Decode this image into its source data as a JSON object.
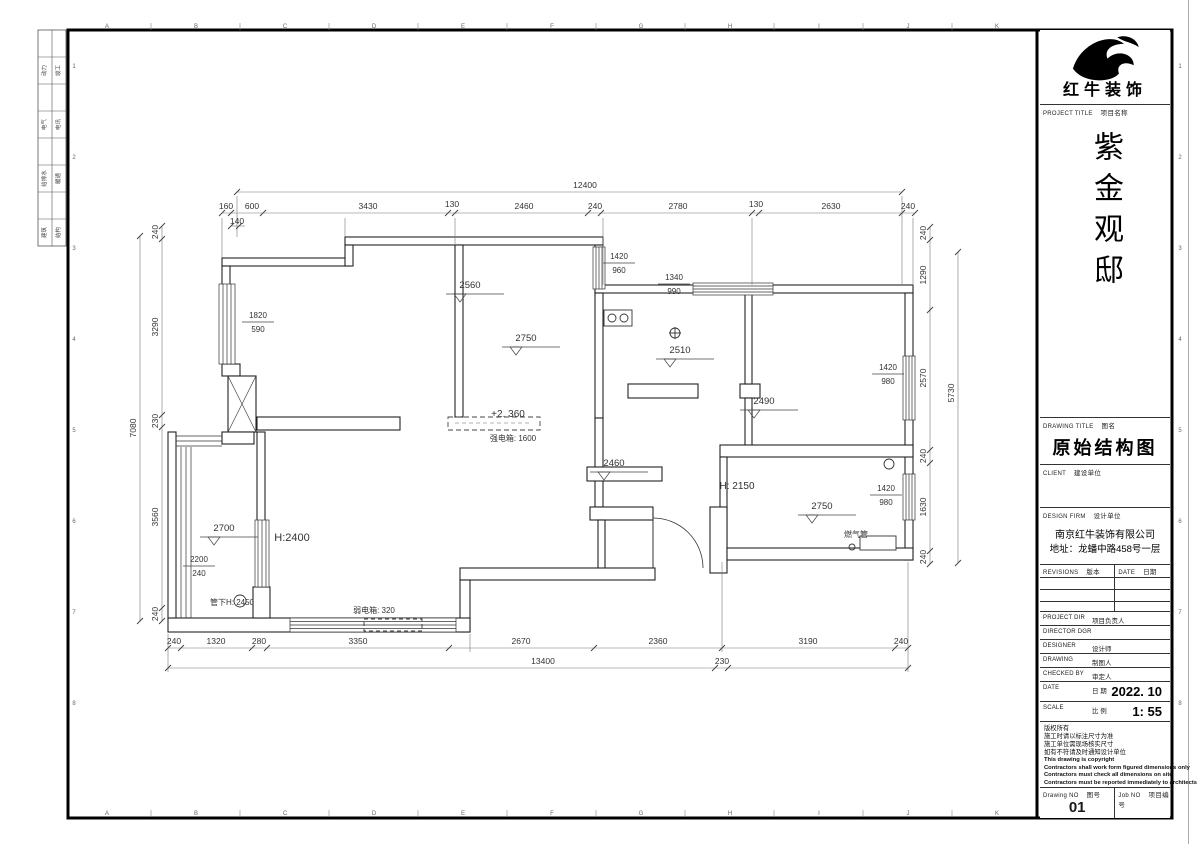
{
  "sheet": {
    "top_letters": [
      "A",
      "B",
      "C",
      "D",
      "E",
      "F",
      "G",
      "H",
      "I",
      "J",
      "K"
    ],
    "side_numbers": [
      "1",
      "2",
      "3",
      "4",
      "5",
      "6",
      "7",
      "8"
    ],
    "stamps": [
      [
        "动力",
        "竣工"
      ],
      [
        "电气",
        "电讯"
      ],
      [
        "给排水",
        "暖通"
      ],
      [
        "建筑",
        "结构"
      ]
    ]
  },
  "title_block": {
    "brand": "红牛装饰",
    "project_label_en": "PROJECT TITLE",
    "project_label_cn": "项目名称",
    "project_name": "紫金观邸",
    "drawing_title_label_en": "DRAWING TITLE",
    "drawing_title_label_cn": "图名",
    "drawing_title": "原始结构图",
    "client_label_en": "CLIENT",
    "client_label_cn": "建设单位",
    "firm_label_en": "DESIGN FIRM",
    "firm_label_cn": "设计单位",
    "firm_name": "南京红牛装饰有限公司",
    "firm_address": "地址：龙蟠中路458号一层",
    "revisions_label_en": "REVISIONS",
    "revisions_label_cn": "版本",
    "date_col_label_en": "DATE",
    "date_col_label_cn": "日期",
    "rows": [
      {
        "en": "PROJECT DIR",
        "cn": "项目负责人",
        "value": ""
      },
      {
        "en": "DIRECTOR DGR",
        "cn": "",
        "value": ""
      },
      {
        "en": "DESIGNER",
        "cn": "设计师",
        "value": ""
      },
      {
        "en": "DRAWING",
        "cn": "制图人",
        "value": ""
      },
      {
        "en": "CHECKED BY",
        "cn": "审定人",
        "value": ""
      },
      {
        "en": "DATE",
        "cn": "日 期",
        "value": "2022. 10"
      },
      {
        "en": "SCALE",
        "cn": "比 例",
        "value": "1: 55"
      }
    ],
    "notes": [
      {
        "text": "版权所有",
        "lang": "cn"
      },
      {
        "text": "施工时请以标注尺寸为准",
        "lang": "cn"
      },
      {
        "text": "施工单位需现场核实尺寸",
        "lang": "cn"
      },
      {
        "text": "如有不符请及时通知设计单位",
        "lang": "cn"
      },
      {
        "text": "This drawing is copyright",
        "lang": "en"
      },
      {
        "text": "Contractors shall work form figured dimensions only",
        "lang": "en"
      },
      {
        "text": "Contractors must check all dimensions on site",
        "lang": "en"
      },
      {
        "text": "Contractors must be reported immediately to architects",
        "lang": "en"
      }
    ],
    "drawing_no_label_en": "Drawing NO",
    "drawing_no_label_cn": "图号",
    "drawing_no": "01",
    "job_no_label_en": "Job NO",
    "job_no_label_cn": "项目编号"
  },
  "plan": {
    "dims": [
      {
        "t": "12400",
        "x": 585,
        "y": 188
      },
      {
        "t": "160",
        "x": 226,
        "y": 209
      },
      {
        "t": "600",
        "x": 252,
        "y": 209
      },
      {
        "t": "3430",
        "x": 368,
        "y": 209
      },
      {
        "t": "130",
        "x": 452,
        "y": 207
      },
      {
        "t": "2460",
        "x": 524,
        "y": 209
      },
      {
        "t": "240",
        "x": 595,
        "y": 209
      },
      {
        "t": "2780",
        "x": 678,
        "y": 209
      },
      {
        "t": "130",
        "x": 756,
        "y": 207
      },
      {
        "t": "2630",
        "x": 831,
        "y": 209
      },
      {
        "t": "240",
        "x": 908,
        "y": 209
      },
      {
        "t": "140",
        "x": 237,
        "y": 224
      },
      {
        "t": "240",
        "x": 174,
        "y": 644
      },
      {
        "t": "1320",
        "x": 216,
        "y": 644
      },
      {
        "t": "280",
        "x": 259,
        "y": 644
      },
      {
        "t": "3350",
        "x": 358,
        "y": 644
      },
      {
        "t": "2670",
        "x": 521,
        "y": 644
      },
      {
        "t": "2360",
        "x": 658,
        "y": 644
      },
      {
        "t": "3190",
        "x": 808,
        "y": 644
      },
      {
        "t": "240",
        "x": 901,
        "y": 644
      },
      {
        "t": "13400",
        "x": 543,
        "y": 664
      },
      {
        "t": "230",
        "x": 722,
        "y": 664
      },
      {
        "t": "240",
        "x": 158,
        "y": 232,
        "r": -90
      },
      {
        "t": "3290",
        "x": 158,
        "y": 327,
        "r": -90
      },
      {
        "t": "230",
        "x": 158,
        "y": 421,
        "r": -90
      },
      {
        "t": "3560",
        "x": 158,
        "y": 517,
        "r": -90
      },
      {
        "t": "240",
        "x": 158,
        "y": 614,
        "r": -90
      },
      {
        "t": "7080",
        "x": 136,
        "y": 428,
        "r": -90
      },
      {
        "t": "240",
        "x": 926,
        "y": 233,
        "r": -90
      },
      {
        "t": "1290",
        "x": 926,
        "y": 275,
        "r": -90
      },
      {
        "t": "2570",
        "x": 926,
        "y": 378,
        "r": -90
      },
      {
        "t": "240",
        "x": 926,
        "y": 456,
        "r": -90
      },
      {
        "t": "1630",
        "x": 926,
        "y": 507,
        "r": -90
      },
      {
        "t": "240",
        "x": 926,
        "y": 557,
        "r": -90
      },
      {
        "t": "5730",
        "x": 954,
        "y": 393,
        "r": -90
      }
    ],
    "levels": [
      {
        "t": "2560",
        "x": 470,
        "y": 288
      },
      {
        "t": "2750",
        "x": 526,
        "y": 341
      },
      {
        "t": "2510",
        "x": 680,
        "y": 353
      },
      {
        "t": "2490",
        "x": 764,
        "y": 404
      },
      {
        "t": "2460",
        "x": 614,
        "y": 466
      },
      {
        "t": "2750",
        "x": 822,
        "y": 509
      },
      {
        "t": "2700",
        "x": 224,
        "y": 531
      }
    ],
    "fracs": [
      {
        "a": "1820",
        "b": "590",
        "x": 258,
        "y": 318
      },
      {
        "a": "1420",
        "b": "960",
        "x": 619,
        "y": 259
      },
      {
        "a": "1340",
        "b": "990",
        "x": 674,
        "y": 280
      },
      {
        "a": "1420",
        "b": "980",
        "x": 888,
        "y": 370
      },
      {
        "a": "1420",
        "b": "980",
        "x": 886,
        "y": 491
      },
      {
        "a": "2200",
        "b": "240",
        "x": 199,
        "y": 562
      }
    ],
    "labels": [
      {
        "t": "+2. 360",
        "x": 508,
        "y": 417,
        "s": 10
      },
      {
        "t": "强电箱: 1600",
        "x": 513,
        "y": 441,
        "s": 8
      },
      {
        "t": "弱电箱: 320",
        "x": 374,
        "y": 613,
        "s": 8
      },
      {
        "t": "管下H: 2450",
        "x": 232,
        "y": 605,
        "s": 8
      },
      {
        "t": "燃气管",
        "x": 856,
        "y": 537,
        "s": 8
      },
      {
        "t": "H:2400",
        "x": 292,
        "y": 541,
        "s": 11
      },
      {
        "t": "H: 2150",
        "x": 737,
        "y": 489,
        "s": 10
      }
    ]
  }
}
